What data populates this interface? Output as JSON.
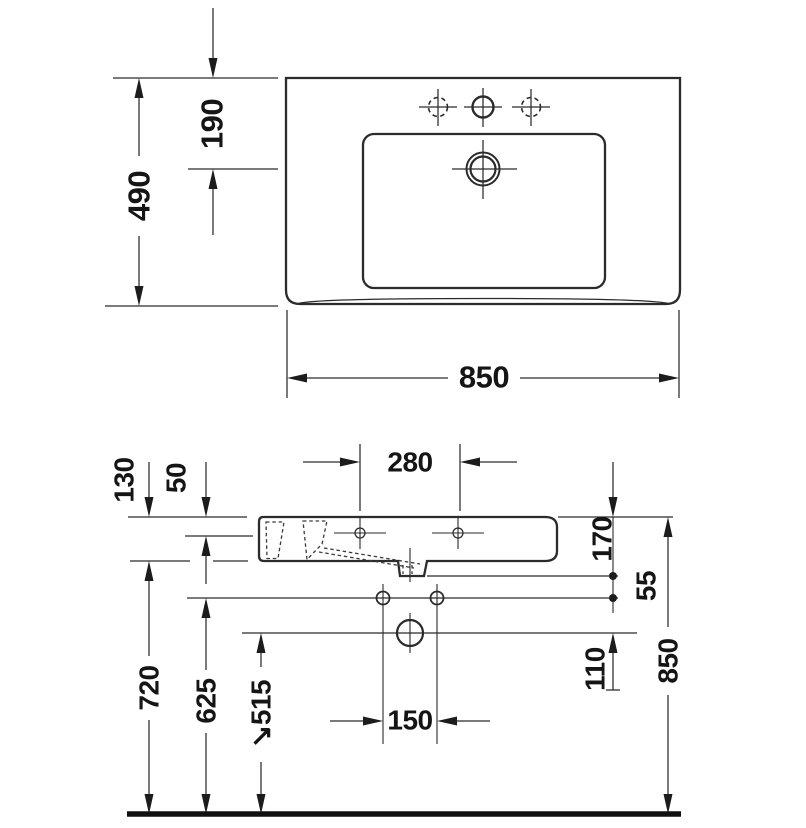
{
  "drawing_type": "washbasin technical dimension drawing",
  "colors": {
    "line": "#2b2b2b",
    "text": "#151515",
    "background": "#ffffff",
    "floor": "#111111"
  },
  "top_view": {
    "depth": "490",
    "tap_center_offset": "190",
    "width": "850"
  },
  "side_view": {
    "tap_spacing": "280",
    "basin_height": "130",
    "rim_drop": "50",
    "rim_to_outlet_bottom": "170",
    "outlet_to_fixing_holes": "55",
    "fixing_holes_to_drain": "110",
    "overall_height": "850",
    "floor_to_basin_bottom": "720",
    "floor_to_fixing_holes": "625",
    "floor_to_drain_center": "↘515",
    "drain_hole_spacing": "150"
  }
}
